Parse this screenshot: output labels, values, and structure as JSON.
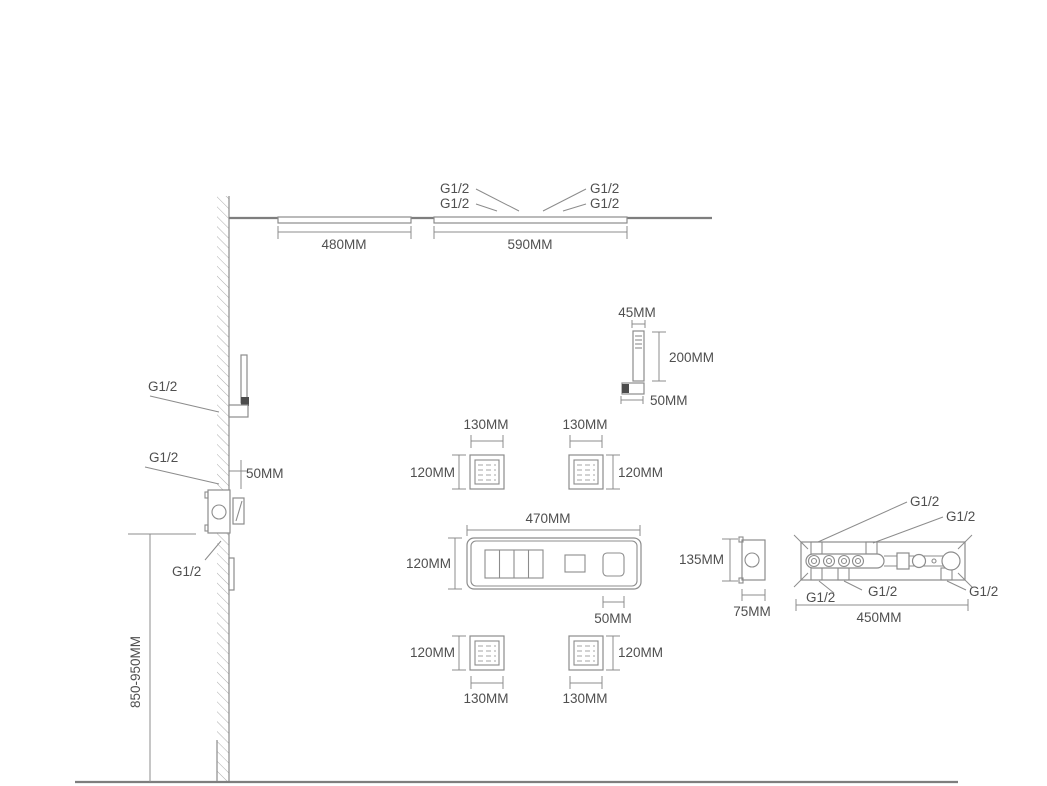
{
  "canvas": {
    "background_color": "#ffffff",
    "line_color": "#8c8c8c",
    "text_color": "#4f4f4f"
  },
  "ceiling_showers": {
    "small_panel_width": "480MM",
    "large_panel_width": "590MM",
    "inlet_labels": [
      "G1/2",
      "G1/2",
      "G1/2",
      "G1/2"
    ]
  },
  "hand_shower": {
    "head_width": "45MM",
    "length": "200MM",
    "bracket_depth": "50MM"
  },
  "wall_column": {
    "upper_outlet_label": "G1/2",
    "mid_outlet_label": "G1/2",
    "outlet_offset": "50MM",
    "valve_lower_label": "G1/2",
    "mounting_height": "850-950MM"
  },
  "body_jets": {
    "top_left": {
      "width": "130MM",
      "height": "120MM"
    },
    "top_right": {
      "width": "130MM",
      "height": "120MM"
    },
    "bottom_left": {
      "width": "130MM",
      "height": "120MM"
    },
    "bottom_right": {
      "width": "130MM",
      "height": "120MM"
    }
  },
  "control_panel": {
    "width": "470MM",
    "height": "120MM",
    "button_width": "50MM"
  },
  "valve_side_view": {
    "height": "135MM",
    "depth": "75MM"
  },
  "valve_rear_view": {
    "width": "450MM",
    "top_labels": [
      "G1/2",
      "G1/2"
    ],
    "bottom_labels": [
      "G1/2",
      "G1/2",
      "G1/2"
    ]
  }
}
